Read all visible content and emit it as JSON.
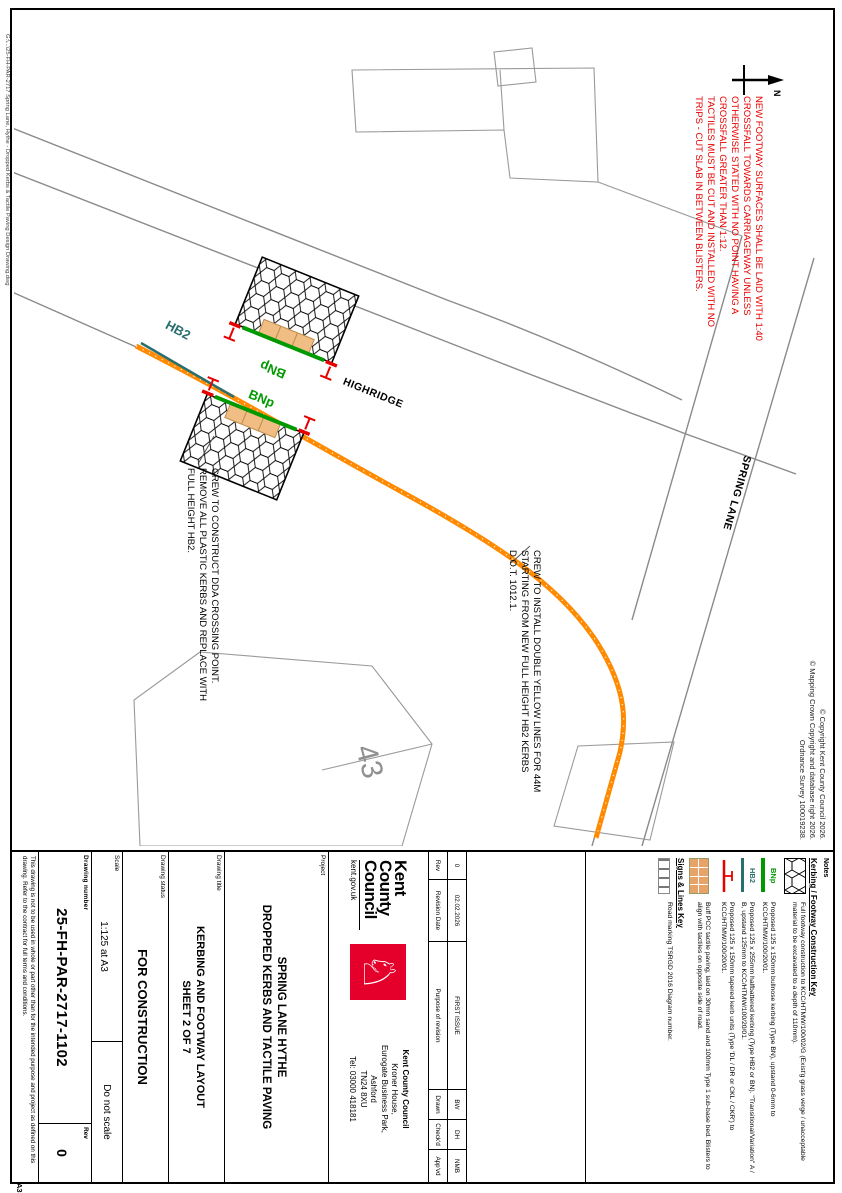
{
  "page": {
    "a3_label": "A3",
    "plot_stamp": "G:\\...\\25-FH-PAR-2717 Spring Lane, Hythe - Dropped Kerbs & Tactile Paving Design Drawing.dwg"
  },
  "copyright": [
    "© Copyright Kent County Council 2026.",
    "© Mapping Crown Copyright and database right 2026.",
    "Ordnance Survey 100019238."
  ],
  "north_label": "N",
  "plan": {
    "red_note": [
      "NEW FOOTWAY SURFACES SHALL BE LAID WITH 1:40",
      "CROSSFALL TOWARDS CARRIAGEWAY UNLESS",
      "OTHERWISE STATED WITH NO POINT HAVING A",
      "CROSSFALL GREATER THAN 1:12.",
      "TACTILES MUST BE CUT AND INSTALLED WITH NO",
      "TRIPS - CUT SLAB IN BETWEEN BLISTERS."
    ],
    "construct_note": [
      "CREW TO CONSTRUCT DDA CROSSING POINT.",
      "REMOVE ALL PLASTIC KERBS AND REPLACE WITH",
      "FULL HEIGHT HB2."
    ],
    "install_note": [
      "CREW TO INSTALL DOUBLE YELLOW LINES FOR 44M",
      "STARTING FROM NEW FULL HEIGHT HB2 KERBS",
      "D.O.T. 1012.1."
    ],
    "labels": {
      "hb2": "HB2",
      "bnp": "BNp",
      "highridge": "HIGHRIDGE",
      "spring_lane": "SPRING LANE",
      "house_number": "43"
    }
  },
  "key": {
    "notes_label": "Notes",
    "construction_title": "Kerbing / Footway Construction Key",
    "items": [
      {
        "swatch": "hex-footway",
        "text": "Full footway construction to KCC/HTMW/100/02/G (Exist'g grass verge / unacceptable material to be excavated to a depth of 110mm)."
      },
      {
        "swatch": "green-kerb-line",
        "label": "BNp",
        "text": "Proposed 125 x 150mm bullnose kerbing (Type BN), upstand 0-6mm to KCC/HTMW/100/20/01."
      },
      {
        "swatch": "teal-kerb-line",
        "label": "HB2",
        "text": "Proposed 125 x 255mm halfbattered kerbing (Type HB2 or BN). \"Transitional/Variation\" A / B, upstand 125mm to KCC/HTMW/100/20/01."
      },
      {
        "swatch": "red-taper-kerb",
        "text": "Proposed 125 x 150mm tapered kerb units (Type 'DL / DR or CKL / CKR') to KCC/HTMW/100/20/01."
      },
      {
        "swatch": "tactile-paving",
        "text": "Buff PCC tactile paving, laid on 30mm sand and 100mm Type 1 sub-base bed. Blisters to align with tactiles on opposite side of road."
      }
    ],
    "signs_title": "Signs & Lines Key",
    "signs_items": [
      {
        "swatch": "road-marking",
        "text": "Road marking TSRGD 2016 Diagram number."
      }
    ]
  },
  "revision": {
    "headers": {
      "rev": "Rev",
      "date": "Revision Date",
      "purpose": "Purpose of revision",
      "drawn": "Drawn",
      "checkd": "Check'd",
      "appvd": "App'vd"
    },
    "entry": {
      "rev": "0",
      "date": "02.02.2026",
      "purpose": "FIRST ISSUE",
      "drawn": "BW",
      "checkd": "DH",
      "appvd": "NMB"
    }
  },
  "logo": {
    "line1": "Kent",
    "line2": "County",
    "line3": "Council",
    "url": "kent.gov.uk",
    "horse_glyph": "♘"
  },
  "address": {
    "name": "Kent County Council",
    "lines": [
      "Kroner House,",
      "Eurogate Business Park,",
      "Ashford",
      "TN24 8XU",
      "Tel: 03000 418181"
    ]
  },
  "titleblock": {
    "project_label": "Project",
    "project_line1": "SPRING LANE HYTHE",
    "project_line2": "DROPPED KERBS AND TACTILE PAVING",
    "title_label": "Drawing title",
    "title_line1": "KERBING AND FOOTWAY LAYOUT",
    "title_line2": "SHEET 2 OF 7",
    "status_label": "Drawing status",
    "status_value": "FOR CONSTRUCTION",
    "scale_label": "Scale",
    "scale_value": "1:125 at A3",
    "do_not_scale": "Do not scale",
    "number_label": "Drawing number",
    "number_value": "25-FH-PAR-2717-1102",
    "rev_label": "Rev",
    "rev_value": "0",
    "disclaimer": "This drawing is not to be used in whole or part other than for the intended purpose and project as defined on this drawing. Refer to the contract for full terms and conditions."
  },
  "colors": {
    "orange_kerb": "#FF8A00",
    "green_kerb": "#009900",
    "teal_kerb": "#2a6f6f",
    "red_note": "#E60000",
    "kcc_red": "#e4002b",
    "tactile_buff": "#f0bd85",
    "road_gray": "#8a8a8a"
  }
}
